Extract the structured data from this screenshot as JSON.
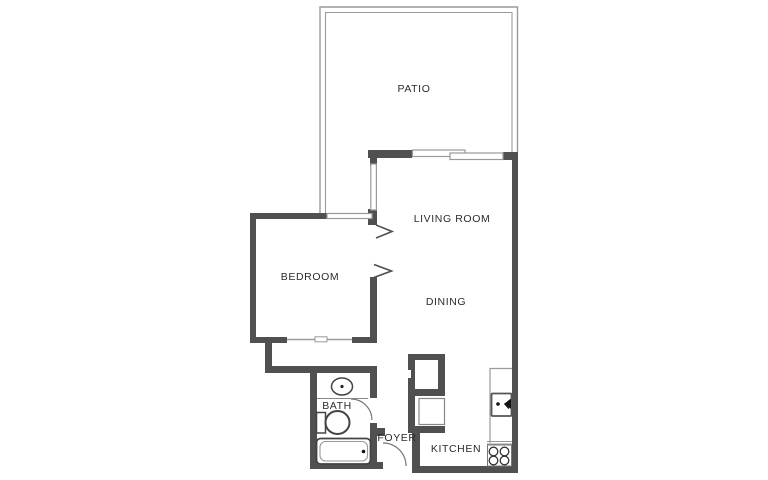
{
  "title": "One-bedroom apartment floor plan",
  "rooms": [
    {
      "id": "patio",
      "label": "PATIO"
    },
    {
      "id": "living",
      "label": "LIVING ROOM"
    },
    {
      "id": "bedroom",
      "label": "BEDROOM"
    },
    {
      "id": "dining",
      "label": "DINING"
    },
    {
      "id": "bath",
      "label": "BATH"
    },
    {
      "id": "foyer",
      "label": "FOYER"
    },
    {
      "id": "kitchen",
      "label": "KITCHEN"
    }
  ],
  "fixtures": [
    "vanity-sink",
    "toilet",
    "bathtub",
    "kitchen-sink",
    "stove",
    "appliance",
    "closet",
    "entry-door",
    "bath-door",
    "sliding-glass-door",
    "closet-sliding-door",
    "door-swing-chevrons"
  ],
  "colors": {
    "background": "#ffffff",
    "wall": "#505050",
    "thin_line": "#9a9a9a",
    "fixture_line": "#444444",
    "text": "#2b2b2b"
  }
}
